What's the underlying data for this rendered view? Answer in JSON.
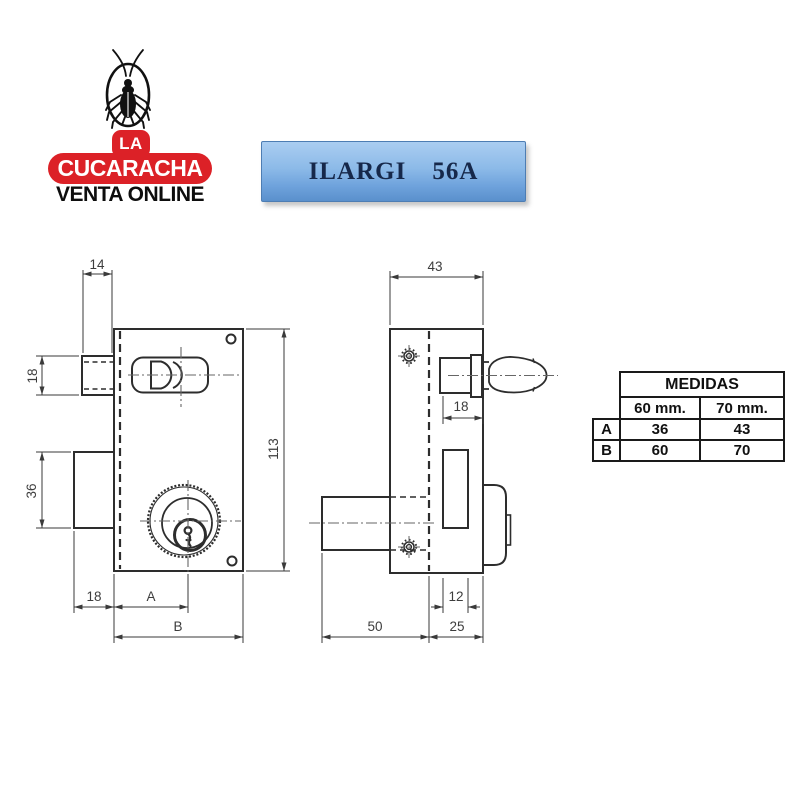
{
  "logo": {
    "icon": "cockroach-icon",
    "la": "LA",
    "name": "CUCARACHA",
    "subtitle": "VENTA ONLINE",
    "brand_red": "#dc2127"
  },
  "banner": {
    "model": "ILARGI",
    "code": "56A",
    "bg_top": "#a9cdf1",
    "bg_bottom": "#5a90cc",
    "text_color": "#16284a"
  },
  "drawing": {
    "line_color": "#2d2d2d",
    "front_view": {
      "latch_width": "14",
      "latch_height": "18",
      "deadbolt_height": "36",
      "body_height": "113",
      "deadbolt_offset": "18",
      "backset_label": "A",
      "body_width_label": "B"
    },
    "side_view": {
      "body_depth": "43",
      "knob_base_width": "18",
      "guide_width": "12",
      "cylinder_length": "50",
      "case_depth": "25"
    }
  },
  "medidas_table": {
    "title": "MEDIDAS",
    "columns": [
      "60 mm.",
      "70 mm."
    ],
    "rows": [
      {
        "label": "A",
        "values": [
          "36",
          "43"
        ]
      },
      {
        "label": "B",
        "values": [
          "60",
          "70"
        ]
      }
    ]
  }
}
